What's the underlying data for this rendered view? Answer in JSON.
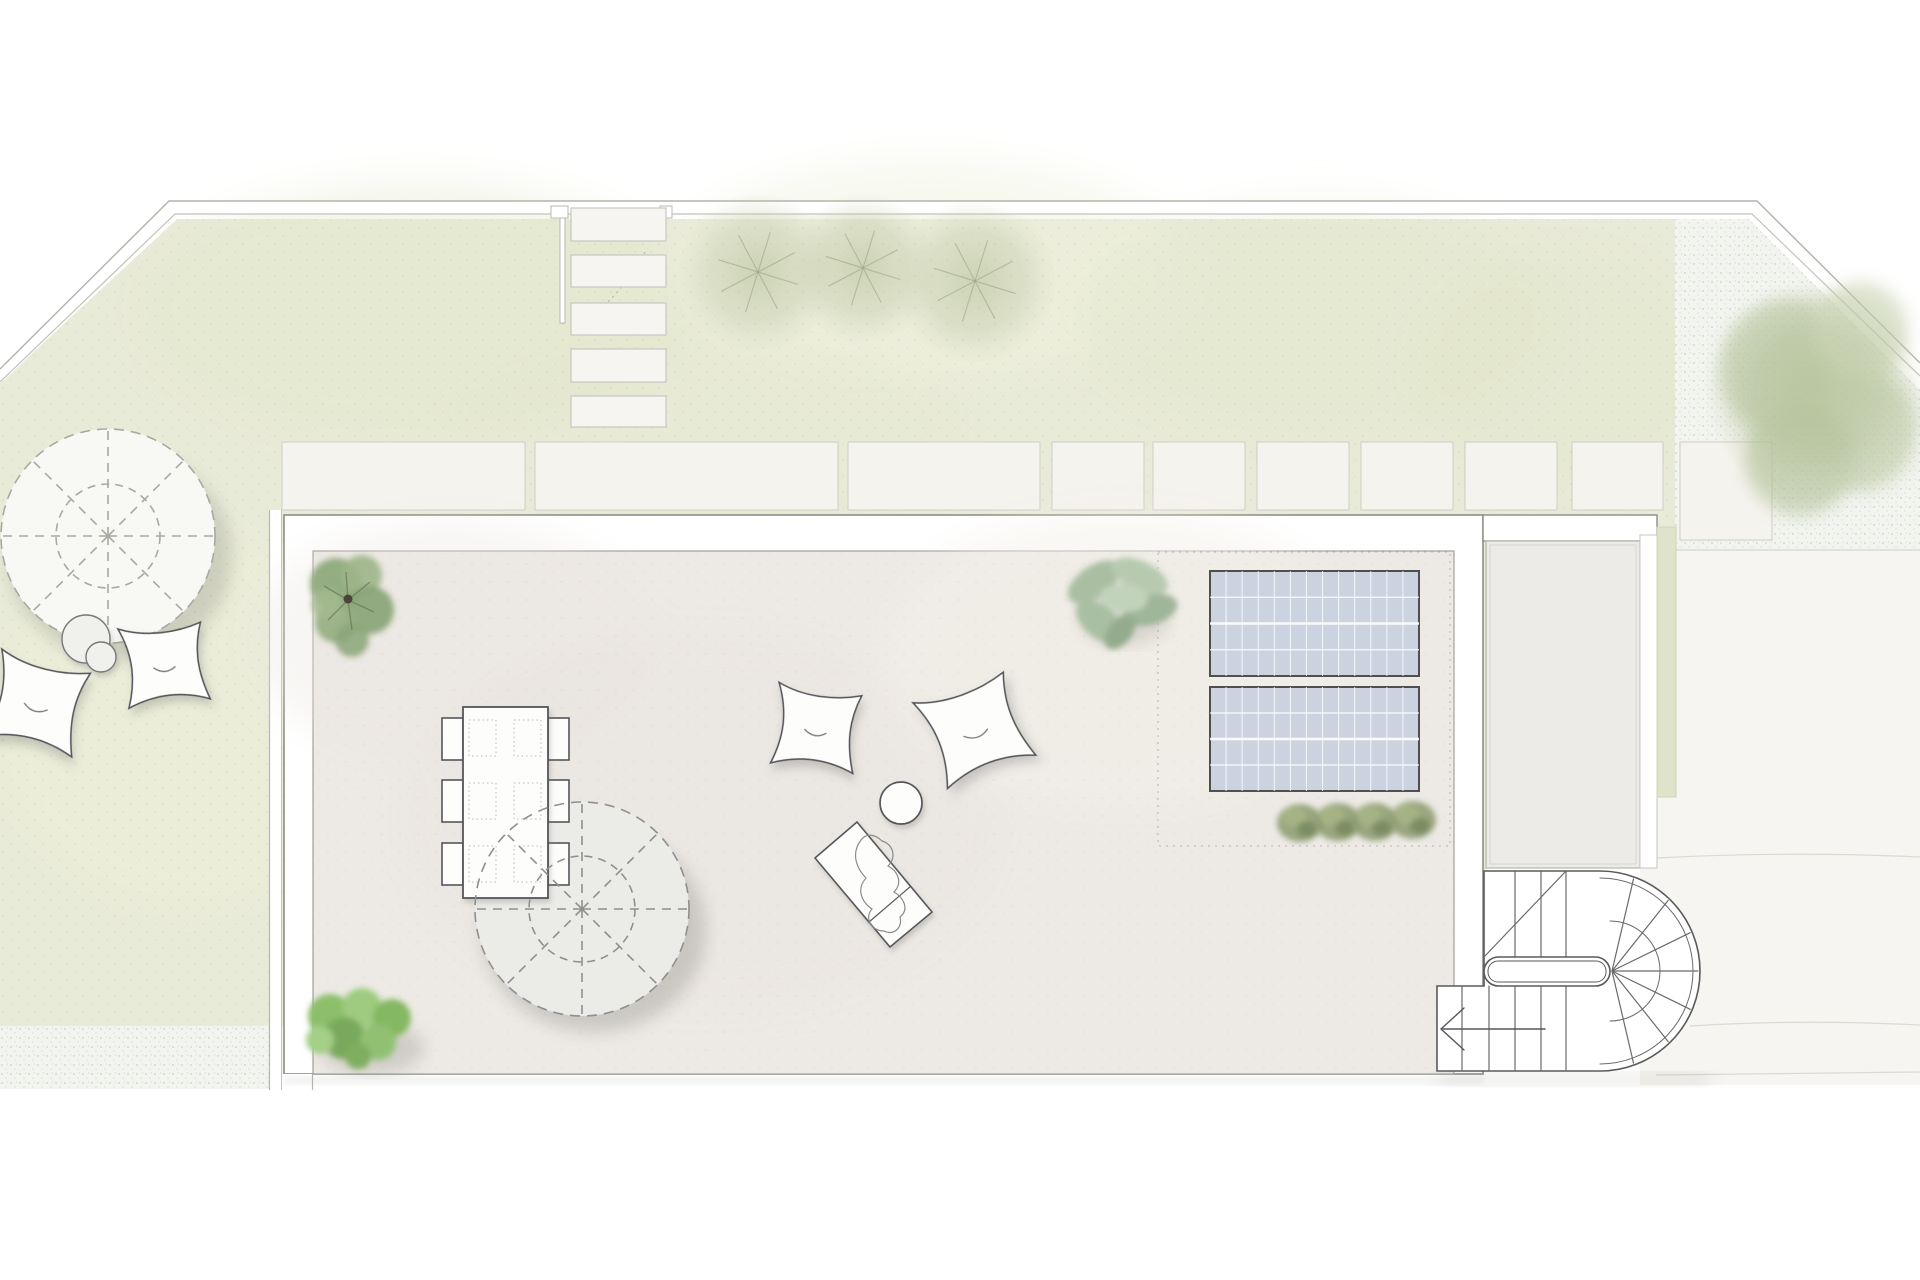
{
  "plan": {
    "title": "roof-terrace-site-plan",
    "canvas": {
      "w": 1920,
      "h": 1280
    },
    "palette": {
      "page": "#ffffff",
      "lawn": "#e9ebd9",
      "gravel": "#f2f4ef",
      "pavement": "#f7f5f1",
      "paver": "#f5f3ee",
      "paver_line": "#cfccc5",
      "boundary_line": "#b3b2ab",
      "terrace_border": "#ffffff",
      "terrace_edge": "#8e8c87",
      "terrace_floor": "#edeae5",
      "wing_roof": "#edebe7",
      "green_strip": "#dfe3c9",
      "furniture_fill": "#fdfdfc",
      "furniture_line": "#55565a",
      "parasol_terrace": "#ebebe8",
      "parasol_garden": "#f8f8f5",
      "dash_line": "#8f8f8f",
      "solar_fill": "#ccd3e0",
      "solar_line": "#4f4f4f",
      "stair_line": "#5a5a5a",
      "bush_green": "#85b862",
      "sage_green": "#a9bfa3",
      "grass_green": "#8a9a6d",
      "tree_sage": "#b9c2a0"
    },
    "boundary": {
      "outer_path": "M0,369 L169,201 L1757,201 L1920,363",
      "inner_path": "M0,382 L175,214 L1752,214 L1920,376",
      "band_path": "M0,375.5 L172,207.5 L1754.5,207.5 L1920,369.5"
    },
    "lawn_points": "177,219 1675,219 1675,560 1486,560 1486,870 1484,870 1484,1074 269,1074 269,1026 0,1026 0,383",
    "garden": {
      "stepping_stones": [
        {
          "x": 571,
          "y": 208,
          "w": 95,
          "h": 33
        },
        {
          "x": 571,
          "y": 255,
          "w": 95,
          "h": 32
        },
        {
          "x": 571,
          "y": 303,
          "w": 95,
          "h": 32
        },
        {
          "x": 571,
          "y": 349,
          "w": 95,
          "h": 33
        },
        {
          "x": 571,
          "y": 396,
          "w": 95,
          "h": 31
        }
      ],
      "gate": {
        "post": {
          "x": 560,
          "y": 212,
          "w": 5,
          "h": 111
        },
        "bracket_left": {
          "x": 551,
          "y": 206,
          "w": 17,
          "h": 12
        },
        "bracket_right": {
          "x": 660,
          "y": 206,
          "w": 12,
          "h": 12
        },
        "swing_arc": "M645,252 Q608,316 572,322"
      },
      "pavers": [
        {
          "x": 282,
          "y": 442,
          "w": 243,
          "h": 68
        },
        {
          "x": 535,
          "y": 442,
          "w": 303,
          "h": 68
        },
        {
          "x": 848,
          "y": 442,
          "w": 192,
          "h": 68
        },
        {
          "x": 1052,
          "y": 442,
          "w": 92,
          "h": 68
        },
        {
          "x": 1153,
          "y": 442,
          "w": 92,
          "h": 68
        },
        {
          "x": 1257,
          "y": 442,
          "w": 92,
          "h": 68
        },
        {
          "x": 1361,
          "y": 442,
          "w": 92,
          "h": 68
        },
        {
          "x": 1465,
          "y": 442,
          "w": 92,
          "h": 68
        },
        {
          "x": 1572,
          "y": 442,
          "w": 91,
          "h": 68
        },
        {
          "x": 1680,
          "y": 442,
          "w": 92,
          "h": 98
        }
      ],
      "trees_top": [
        {
          "cx": 758,
          "cy": 272,
          "r": 80
        },
        {
          "cx": 863,
          "cy": 268,
          "r": 75
        },
        {
          "cx": 975,
          "cy": 281,
          "r": 82
        }
      ],
      "tree_right": {
        "cx": 1817,
        "cy": 392,
        "r": 112
      },
      "gravel_top_right": "1675,219 1749,219 1920,390 1920,550 1675,550",
      "gravel_bottom_left": {
        "x": 0,
        "y": 1026,
        "w": 310,
        "h": 63
      },
      "parasol": {
        "cx": 108,
        "cy": 536,
        "r": 107,
        "inner_r": 52
      },
      "side_tables": [
        {
          "cx": 86,
          "cy": 639,
          "r": 24
        },
        {
          "cx": 101,
          "cy": 657,
          "r": 15
        }
      ],
      "bean_bags": [
        {
          "cx": 37,
          "cy": 702,
          "s": 1.02,
          "rot": 14
        },
        {
          "cx": 164,
          "cy": 663,
          "s": 0.92,
          "rot": -6
        }
      ],
      "fence_line": {
        "x": 269,
        "y": 510,
        "w": 13,
        "h": 580
      }
    },
    "terrace": {
      "outer": {
        "x": 284,
        "y": 515,
        "w": 1199,
        "h": 559
      },
      "interior": {
        "x": 313,
        "y": 551,
        "w": 1141,
        "h": 523
      },
      "extension_band": {
        "x": 1483,
        "y": 515,
        "w": 174,
        "h": 26
      },
      "plant_top_left": {
        "cx": 348,
        "cy": 600
      },
      "dining": {
        "table": {
          "x": 463,
          "y": 707,
          "w": 85,
          "h": 191
        },
        "chair_ys": [
          718,
          780,
          843
        ],
        "chair": {
          "w": 21,
          "h": 42,
          "left_x": 442,
          "right_x": 548
        },
        "placemat_cols": [
          469,
          514
        ],
        "placemat": {
          "w": 27,
          "h": 36
        },
        "placemat_ys": [
          720,
          783,
          846
        ]
      },
      "parasol": {
        "cx": 582,
        "cy": 909,
        "r": 107,
        "inner_r": 53
      },
      "cushions": [
        {
          "cx": 816,
          "cy": 727,
          "s": 0.93,
          "rot": 8
        },
        {
          "cx": 974,
          "cy": 728,
          "s": 1.06,
          "rot": -20
        }
      ],
      "stool": {
        "cx": 901,
        "cy": 803,
        "r": 21
      },
      "lounger": {
        "points": "815,858 857,822 932,912 890,947",
        "divider": "M869,922 L911,886"
      },
      "bush": {
        "cx": 362,
        "cy": 1030
      },
      "solar": {
        "zone": {
          "x": 1158,
          "y": 552,
          "w": 292,
          "h": 294
        },
        "panels": [
          {
            "x": 1210,
            "y": 571,
            "w": 209,
            "h": 105
          },
          {
            "x": 1210,
            "y": 687,
            "w": 209,
            "h": 104
          }
        ],
        "cols": 13,
        "rows": 4
      },
      "grasses": [
        {
          "cx": 1300,
          "cy": 823
        },
        {
          "cx": 1338,
          "cy": 822
        },
        {
          "cx": 1375,
          "cy": 822
        },
        {
          "cx": 1413,
          "cy": 820
        }
      ]
    },
    "right_side": {
      "wing_roof": {
        "x": 1486,
        "y": 541,
        "w": 154,
        "h": 327
      },
      "white_band": {
        "x": 1640,
        "y": 535,
        "w": 17,
        "h": 333
      },
      "green_strip": {
        "x": 1657,
        "y": 527,
        "w": 19,
        "h": 270
      },
      "pavement_points": "1656,550 1920,550 1920,1085 1640,1085 1640,868 1656,868",
      "joint_lines": [
        "M1656,858 Q1790,851 1920,857",
        "M1690,1026 Q1800,1019 1920,1025",
        "M1656,1075 L1920,1072"
      ]
    },
    "stair": {
      "backing": "M1484,871 L1600,871 A100,100 0 0 1 1600,1071 L1437,1071 L1437,986 L1484,986 Z",
      "inner_arc": "M1600,878 A93,93 0 0 1 1600,1064",
      "upper_flight": {
        "x": 1484,
        "y": 871,
        "w": 116,
        "h": 86
      },
      "lower_flight": {
        "x": 1437,
        "y": 986,
        "w": 163,
        "h": 85
      },
      "upper_treads_x": [
        1515,
        1541,
        1566
      ],
      "lower_treads_x": [
        1462,
        1489,
        1515,
        1541,
        1566
      ],
      "diagonal": "M1484,957 L1566,871",
      "divider": {
        "x": 1484,
        "y": 957,
        "w": 126,
        "h": 29,
        "rx": 14.5
      },
      "divider_inner": {
        "x": 1488,
        "y": 961,
        "w": 118,
        "h": 21,
        "rx": 10
      },
      "fan_center": {
        "x": 1612,
        "y": 971
      },
      "fan_angles": [
        -70,
        -46,
        -23,
        0,
        23,
        46,
        70
      ],
      "fan_r": 98,
      "guide_arc": "M1610,921 A50,50 0 0 1 1610,1021",
      "arrow_shaft": "M1443,1029 L1545,1029",
      "arrow_head": "1464,1008 1441,1029 1464,1050"
    }
  }
}
